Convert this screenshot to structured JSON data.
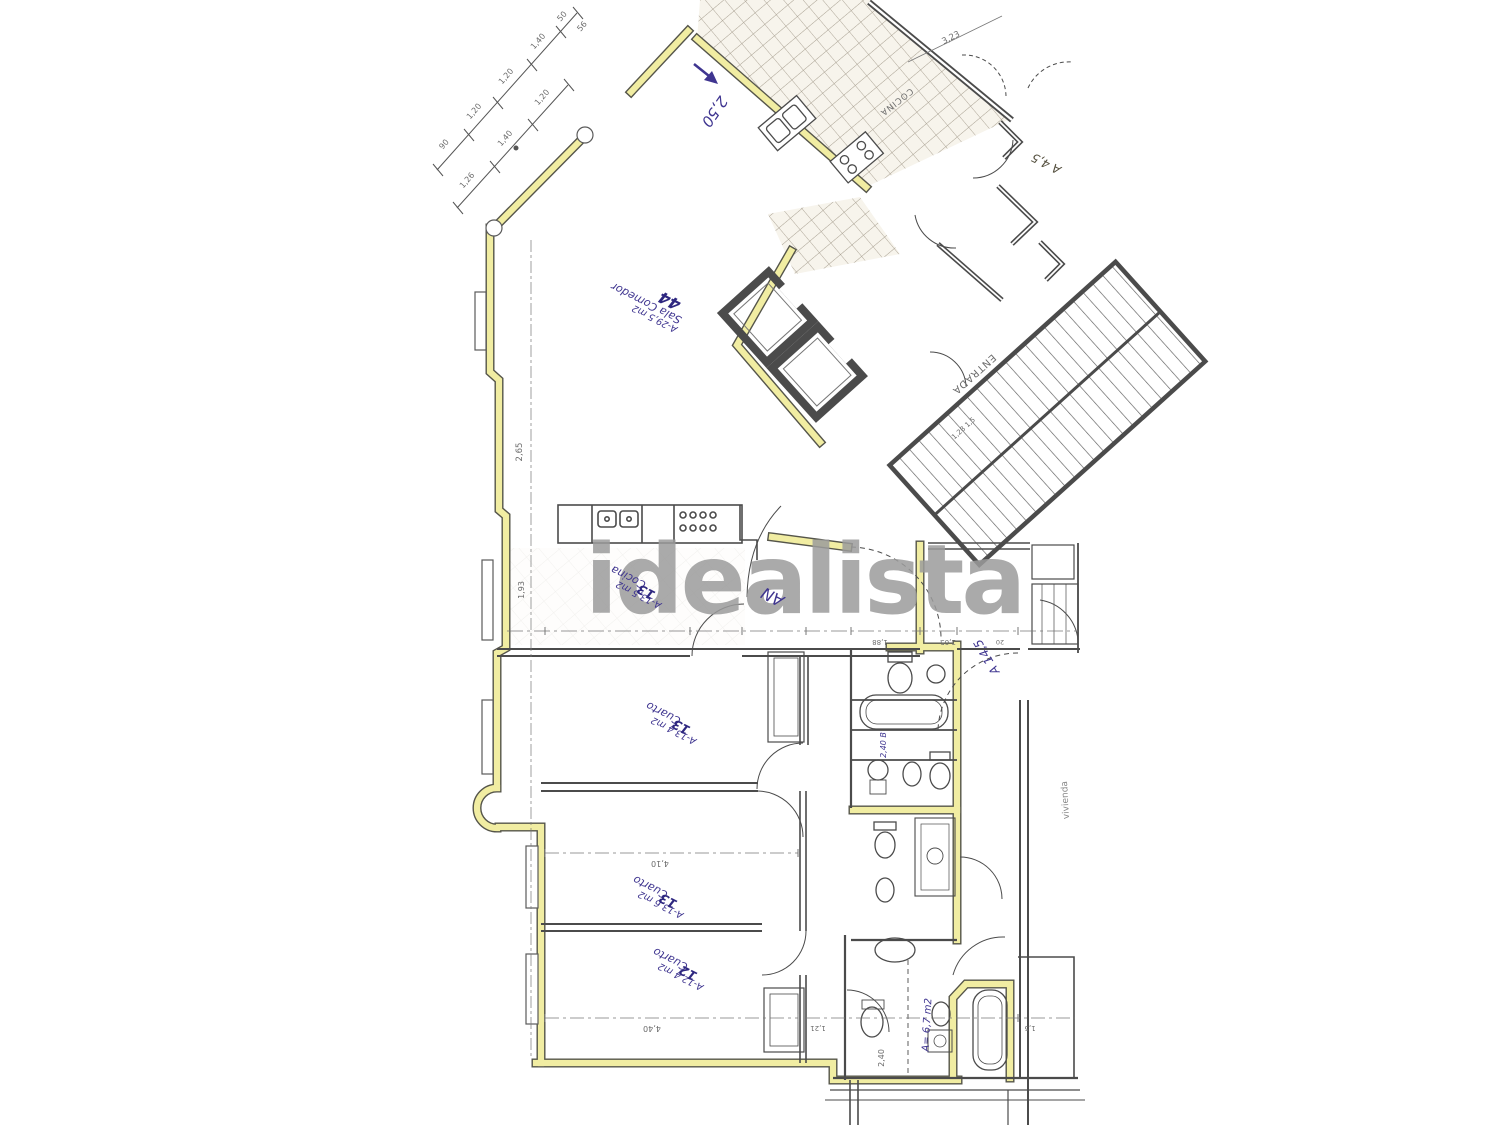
{
  "colors": {
    "highlight_yellow": "#f1eda2",
    "ink_blue": "#3f3590",
    "pencil_gray": "#4b4b4b",
    "watermark_gray": "#9c9c9c"
  },
  "watermark": {
    "text": "idealista"
  },
  "ink_labels": [
    {
      "id": "arrow-dim",
      "text": "2,50"
    },
    {
      "id": "sala-name",
      "text": "Sala Comedor"
    },
    {
      "id": "sala-area",
      "text": "A-29,5 m2"
    },
    {
      "id": "sala-bold",
      "text": "44"
    },
    {
      "id": "cocina-name",
      "text": "Cocina"
    },
    {
      "id": "cocina-area",
      "text": "A-13,5 m2"
    },
    {
      "id": "cocina-bold",
      "text": "13"
    },
    {
      "id": "hall-scribble",
      "text": "AN"
    },
    {
      "id": "hall-area",
      "text": "A 14,5"
    },
    {
      "id": "cuarto1-name",
      "text": "Cuarto"
    },
    {
      "id": "cuarto1-area",
      "text": "A-13,4 m2"
    },
    {
      "id": "cuarto1-bold",
      "text": "13"
    },
    {
      "id": "cuarto2-name",
      "text": "Cuarto"
    },
    {
      "id": "cuarto2-area",
      "text": "A-13,6 m2"
    },
    {
      "id": "cuarto2-bold",
      "text": "13"
    },
    {
      "id": "cuarto3-name",
      "text": "Cuarto"
    },
    {
      "id": "cuarto3-area",
      "text": "A-12,4 m2"
    },
    {
      "id": "cuarto3-bold",
      "text": "12"
    },
    {
      "id": "bano-area",
      "text": "A= 6,7 m2"
    },
    {
      "id": "bath-dim",
      "text": "2,40 B"
    }
  ],
  "pencil_labels": [
    {
      "id": "entrada",
      "text": "ENTRADA"
    },
    {
      "id": "cocina-terraza",
      "text": "COCINA"
    },
    {
      "id": "a45",
      "text": "A 4,5"
    },
    {
      "id": "d323",
      "text": "3,23"
    },
    {
      "id": "d265",
      "text": "2,65"
    },
    {
      "id": "d193",
      "text": "1,93"
    },
    {
      "id": "d410",
      "text": "4,10"
    },
    {
      "id": "d440",
      "text": "4,40"
    },
    {
      "id": "d188",
      "text": "1,88"
    },
    {
      "id": "d205",
      "text": "2,05"
    },
    {
      "id": "d20",
      "text": "20"
    },
    {
      "id": "d128",
      "text": "1,28  1,5"
    },
    {
      "id": "d121",
      "text": "1,21"
    },
    {
      "id": "d15",
      "text": "1,5"
    },
    {
      "id": "d240",
      "text": "2,40"
    },
    {
      "id": "vivienda",
      "text": "vivienda"
    },
    {
      "id": "d56",
      "text": "56"
    },
    {
      "id": "c90",
      "text": "90"
    },
    {
      "id": "c120a",
      "text": "1,20"
    },
    {
      "id": "c120b",
      "text": "1,20"
    },
    {
      "id": "c140",
      "text": "1,40"
    },
    {
      "id": "c50",
      "text": "50"
    },
    {
      "id": "b126",
      "text": "1,26"
    },
    {
      "id": "b140",
      "text": "1,40"
    },
    {
      "id": "b120",
      "text": "1,20"
    }
  ]
}
